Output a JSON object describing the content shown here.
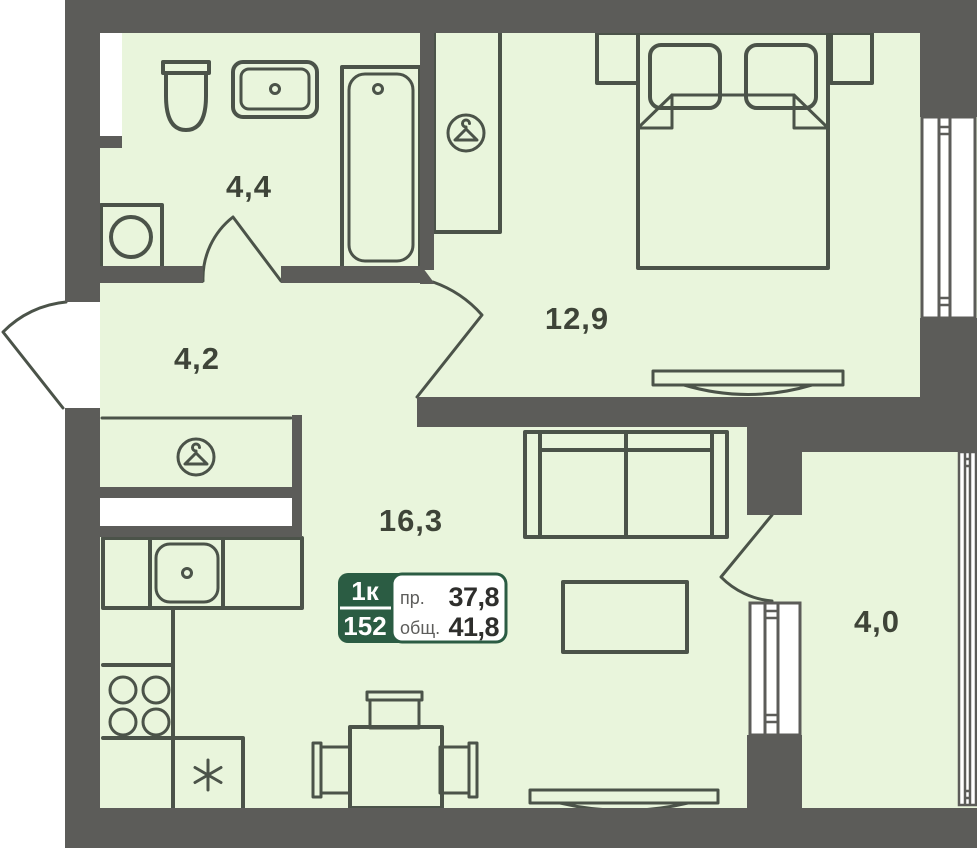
{
  "plan_type": "apartment-floor-plan",
  "rooms": [
    {
      "name": "bathroom",
      "area": "4,4"
    },
    {
      "name": "hallway",
      "area": "4,2"
    },
    {
      "name": "bedroom",
      "area": "12,9"
    },
    {
      "name": "living-kitchen",
      "area": "16,3"
    },
    {
      "name": "balcony",
      "area": "4,0"
    }
  ],
  "info_badge": {
    "unit_type": "1к",
    "unit_number": "152",
    "row1_label": "пр.",
    "row1_value": "37,8",
    "row2_label": "общ.",
    "row2_value": "41,8"
  },
  "fixtures": [
    "toilet",
    "bathroom-sink",
    "bathtub",
    "washing-machine",
    "hall-closet",
    "hanger-icon",
    "kitchen-counter",
    "kitchen-sink",
    "stove-burners",
    "fridge",
    "snowflake-icon",
    "dining-table",
    "dining-chairs",
    "sofa",
    "coffee-table",
    "bed",
    "pillows",
    "nightstands",
    "bedroom-wardrobe",
    "radiators",
    "windows",
    "doors"
  ],
  "colors": {
    "wall": "#5c5c59",
    "floor": "#e9f5dc",
    "fixture_stroke": "#4b5349",
    "label_text": "#3e4438",
    "badge_green": "#2b5c43",
    "background": "#ffffff"
  }
}
